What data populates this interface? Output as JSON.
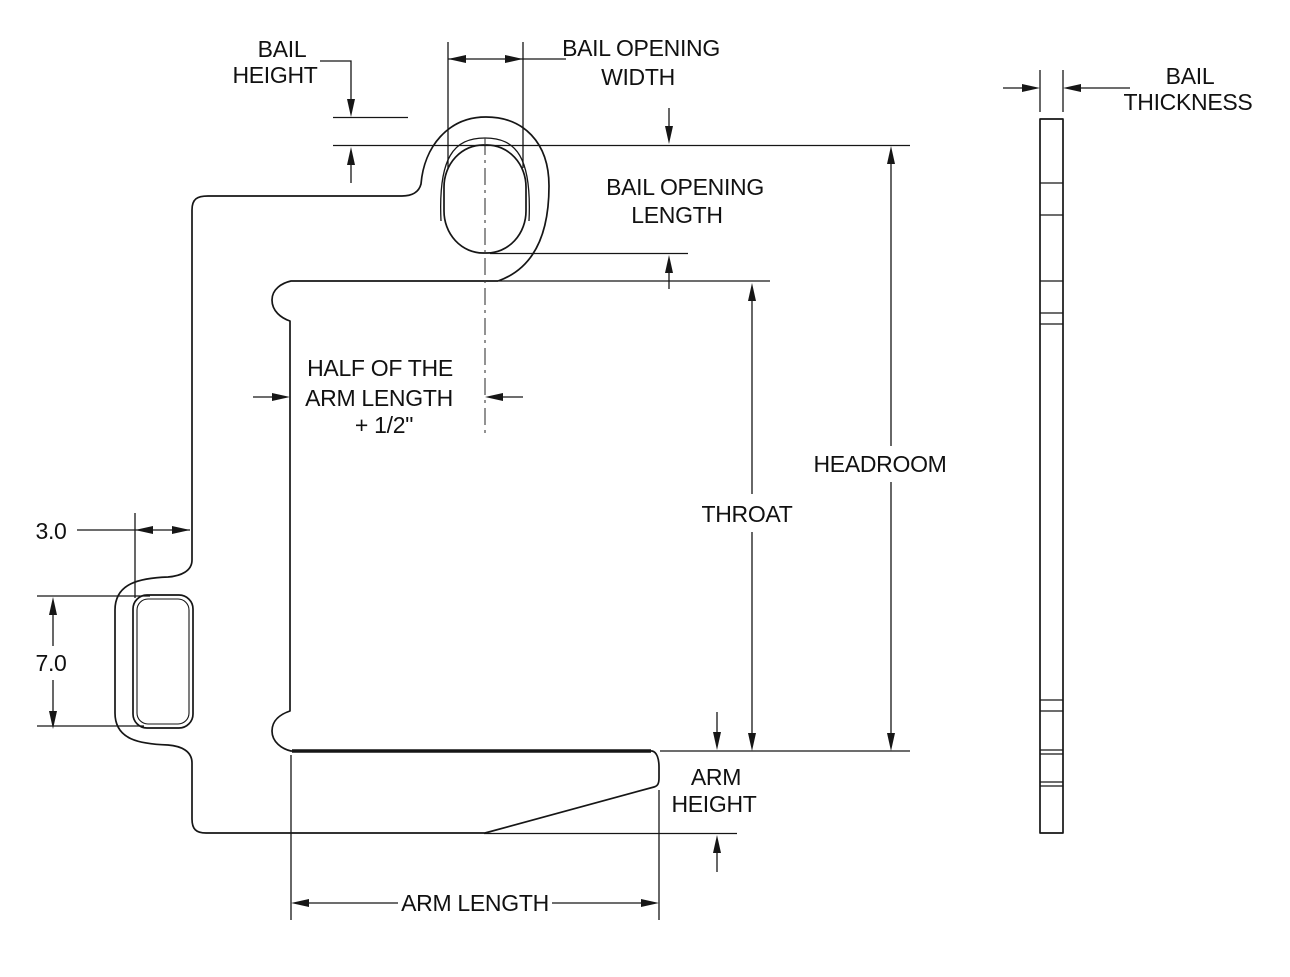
{
  "document": {
    "type": "engineering-dimension-diagram",
    "subject": "C-hook lifter front and side views with dimension callouts",
    "background_color": "#ffffff",
    "line_color": "#161616"
  },
  "labels": {
    "bail_height": [
      "BAIL",
      "HEIGHT"
    ],
    "bail_opening_width": [
      "BAIL OPENING",
      "WIDTH"
    ],
    "bail_opening_length": [
      "BAIL OPENING",
      "LENGTH"
    ],
    "half_arm_length": [
      "HALF OF THE",
      "ARM LENGTH",
      "+ 1/2\""
    ],
    "headroom": "HEADROOM",
    "throat": "THROAT",
    "arm_height": [
      "ARM",
      "HEIGHT"
    ],
    "arm_length": "ARM LENGTH",
    "bail_thickness": [
      "BAIL",
      "THICKNESS"
    ],
    "slot_width": "3.0",
    "slot_height": "7.0"
  }
}
